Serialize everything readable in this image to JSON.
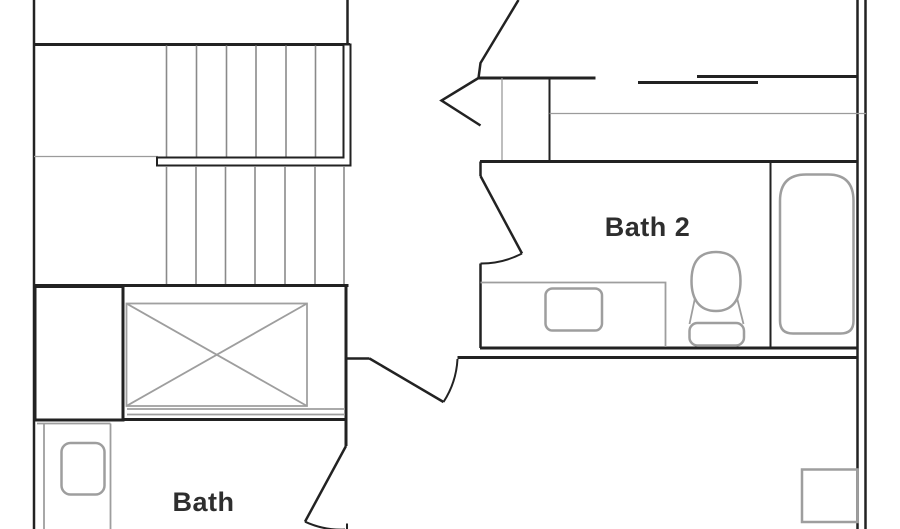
{
  "floor_plan": {
    "labels": {
      "bath2": "Bath 2",
      "bath": "Bath"
    },
    "rooms": [
      {
        "name": "Bath 2"
      },
      {
        "name": "Bath"
      }
    ],
    "fixtures": [
      "staircase",
      "open-to-below-x-box",
      "closet",
      "bathtub",
      "toilet",
      "bath2-vanity-sink",
      "bath-vanity-sink",
      "corner-square-fixture"
    ],
    "colors": {
      "wall": "#222222",
      "fixture_outline": "#9e9e9e",
      "stair_tread": "#8a8a8a",
      "label_text": "#2e2e2e",
      "background": "#ffffff"
    }
  }
}
